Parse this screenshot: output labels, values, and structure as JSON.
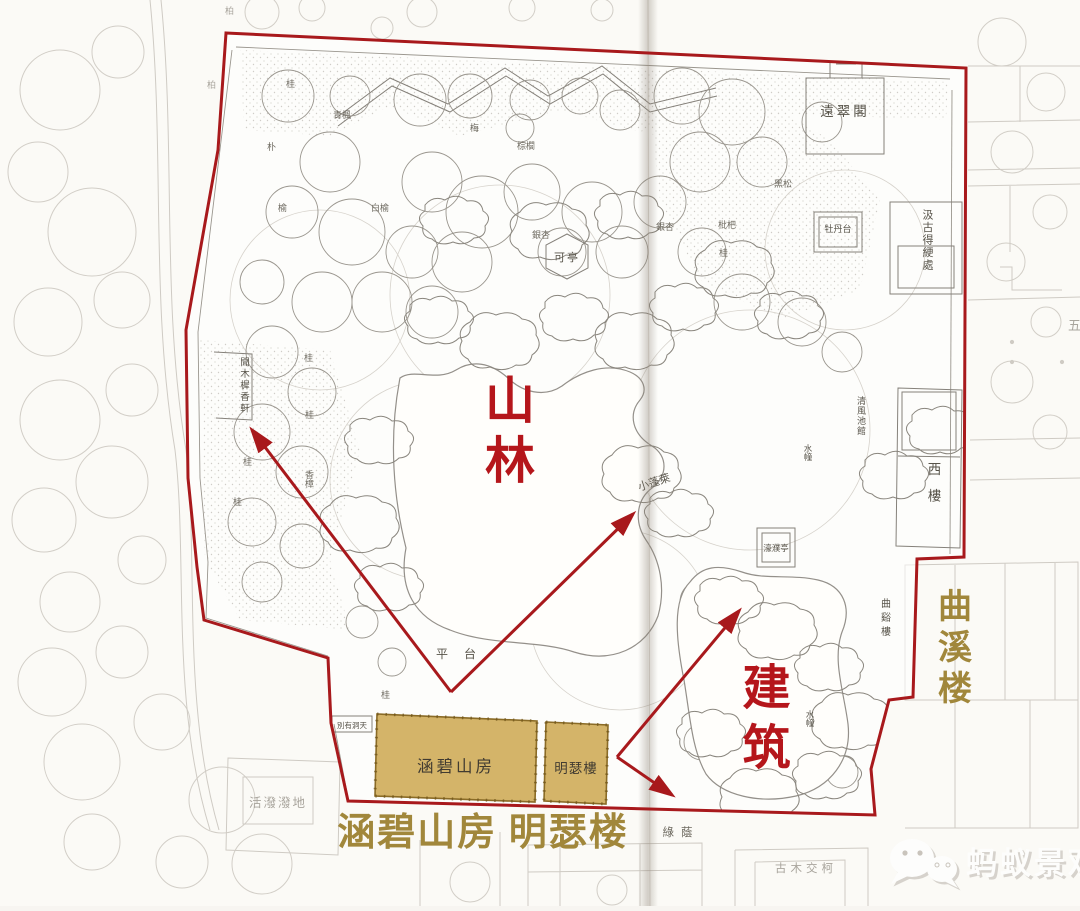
{
  "figure": {
    "kind": "scanned classical garden plan with red analysis overlay",
    "palette": {
      "boundary_red": "#a8191c",
      "annotation_red": "#b5161b",
      "gold_caption": "#a1873b",
      "highlight_building_fill": "#d4b469",
      "highlight_building_border": "#8a6b26",
      "ink": "#575349",
      "faded_ink": "#a9a59d",
      "paper": "#fbfaf6"
    }
  },
  "annotations": {
    "mountain_forest": "山林",
    "architecture": "建筑",
    "bottom_caption": "涵碧山房 明瑟楼",
    "right_caption": "曲溪楼"
  },
  "highlighted_buildings": {
    "hanbi": "涵碧山房",
    "mingse": "明瑟樓"
  },
  "plan_labels": {
    "yuancuige": "遠翠閣",
    "jigu": "汲古得綆處",
    "mudantai": "牡丹台",
    "keting": "可亭",
    "xilou": "西樓",
    "qingfeng": "清風池館",
    "haopu": "濠濮亭",
    "xiaopenglai": "小蓬萊",
    "quxi_small": "曲谿樓",
    "wenmuxi": "聞木樨香軒",
    "pingtai": "平台",
    "lvyin": "綠蔭",
    "bieyou": "別有洞天",
    "shuizha": "水幢",
    "huopo": "活潑潑地",
    "gumu": "古木交柯",
    "wu": "五"
  },
  "tree_labels": {
    "gui": "桂",
    "mei": "梅",
    "zonglv": "棕櫚",
    "yinxing": "銀杏",
    "baiyu": "白榆",
    "qingfengshu": "青楓",
    "pu": "朴",
    "yu": "榆",
    "pipa": "枇杷",
    "xiangzhang": "香樟",
    "heisong": "黑松",
    "bai": "柏"
  },
  "watermark": {
    "logo": "wechat-icon",
    "brand": "蚂蚁景观"
  }
}
